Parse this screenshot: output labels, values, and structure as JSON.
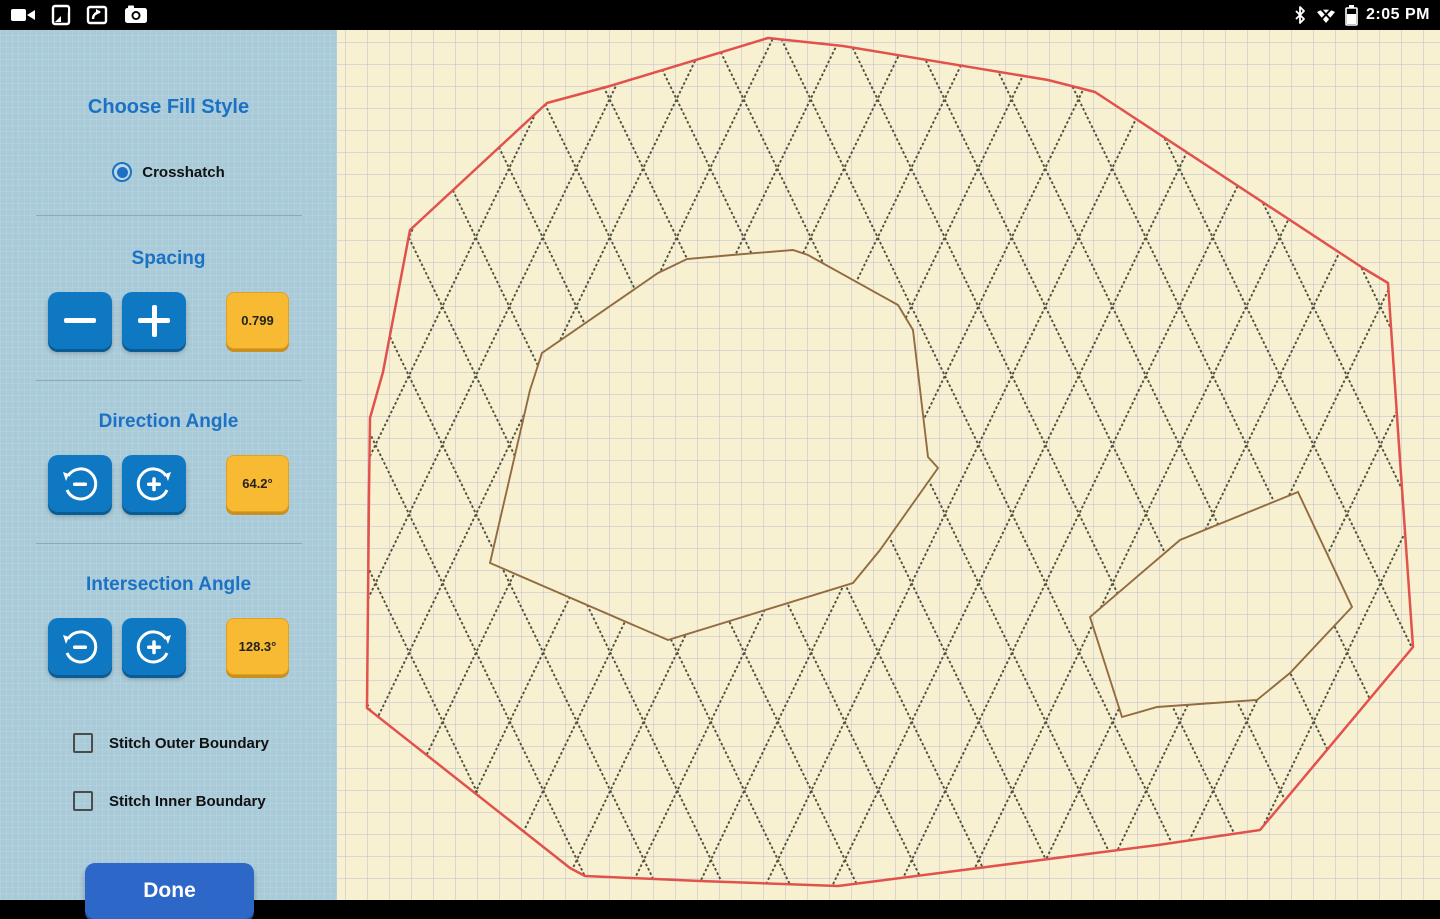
{
  "status_bar": {
    "time": "2:05 PM",
    "left_icons": [
      "video-camera-icon",
      "screenshot-icon",
      "screen-share-icon",
      "camera-icon"
    ],
    "right_icons": [
      "bluetooth-icon",
      "wifi-off-icon",
      "battery-icon"
    ]
  },
  "sidebar": {
    "title": "Choose Fill Style",
    "fill_style_options": [
      {
        "label": "Crosshatch",
        "selected": true
      }
    ],
    "sections": {
      "spacing": {
        "label": "Spacing",
        "value": "0.799"
      },
      "direction_angle": {
        "label": "Direction Angle",
        "value": "64.2°"
      },
      "intersection_angle": {
        "label": "Intersection Angle",
        "value": "128.3°"
      }
    },
    "checkboxes": [
      {
        "label": "Stitch Outer Boundary",
        "checked": false
      },
      {
        "label": "Stitch Inner Boundary",
        "checked": false
      }
    ],
    "done_label": "Done"
  },
  "colors": {
    "sidebar_bg": "#a9cad8",
    "accent_blue": "#1b72c4",
    "button_blue": "#0e78c3",
    "value_orange": "#f8ba33",
    "done_blue": "#2d68c9",
    "canvas_bg": "#f8f1d1",
    "grid": "#bfbcd2",
    "outer_boundary": "#e2524c",
    "hatch": "#50513f",
    "inner_boundary": "#936b40"
  },
  "canvas": {
    "width": 1103,
    "height": 870,
    "grid_size": 22,
    "grid_offset_x": 8,
    "grid_offset_y": 12,
    "hatch": {
      "direction_angle_deg": 64.2,
      "intersection_angle_deg": 128.3,
      "horizontal_period_px": 67,
      "dash": "2.6 2.2",
      "stroke_width": 1.9
    },
    "outer_boundary_points": [
      [
        431,
        8
      ],
      [
        506,
        16
      ],
      [
        711,
        50
      ],
      [
        758,
        62
      ],
      [
        1026,
        238
      ],
      [
        1051,
        253
      ],
      [
        1063,
        430
      ],
      [
        1076,
        617
      ],
      [
        923,
        800
      ],
      [
        821,
        815
      ],
      [
        501,
        856
      ],
      [
        363,
        851
      ],
      [
        248,
        846
      ],
      [
        233,
        838
      ],
      [
        30,
        678
      ],
      [
        32,
        463
      ],
      [
        33,
        388
      ],
      [
        46,
        342
      ],
      [
        73,
        200
      ],
      [
        210,
        73
      ],
      [
        273,
        56
      ]
    ],
    "inner_boundaries_points": [
      [
        [
          321,
          243
        ],
        [
          350,
          229
        ],
        [
          395,
          225
        ],
        [
          456,
          220
        ],
        [
          471,
          225
        ],
        [
          561,
          275
        ],
        [
          576,
          300
        ],
        [
          591,
          427
        ],
        [
          601,
          438
        ],
        [
          543,
          520
        ],
        [
          516,
          553
        ],
        [
          331,
          610
        ],
        [
          153,
          533
        ],
        [
          193,
          360
        ],
        [
          205,
          323
        ]
      ],
      [
        [
          961,
          462
        ],
        [
          1015,
          577
        ],
        [
          953,
          643
        ],
        [
          920,
          670
        ],
        [
          820,
          677
        ],
        [
          785,
          687
        ],
        [
          753,
          587
        ],
        [
          843,
          510
        ]
      ]
    ]
  }
}
